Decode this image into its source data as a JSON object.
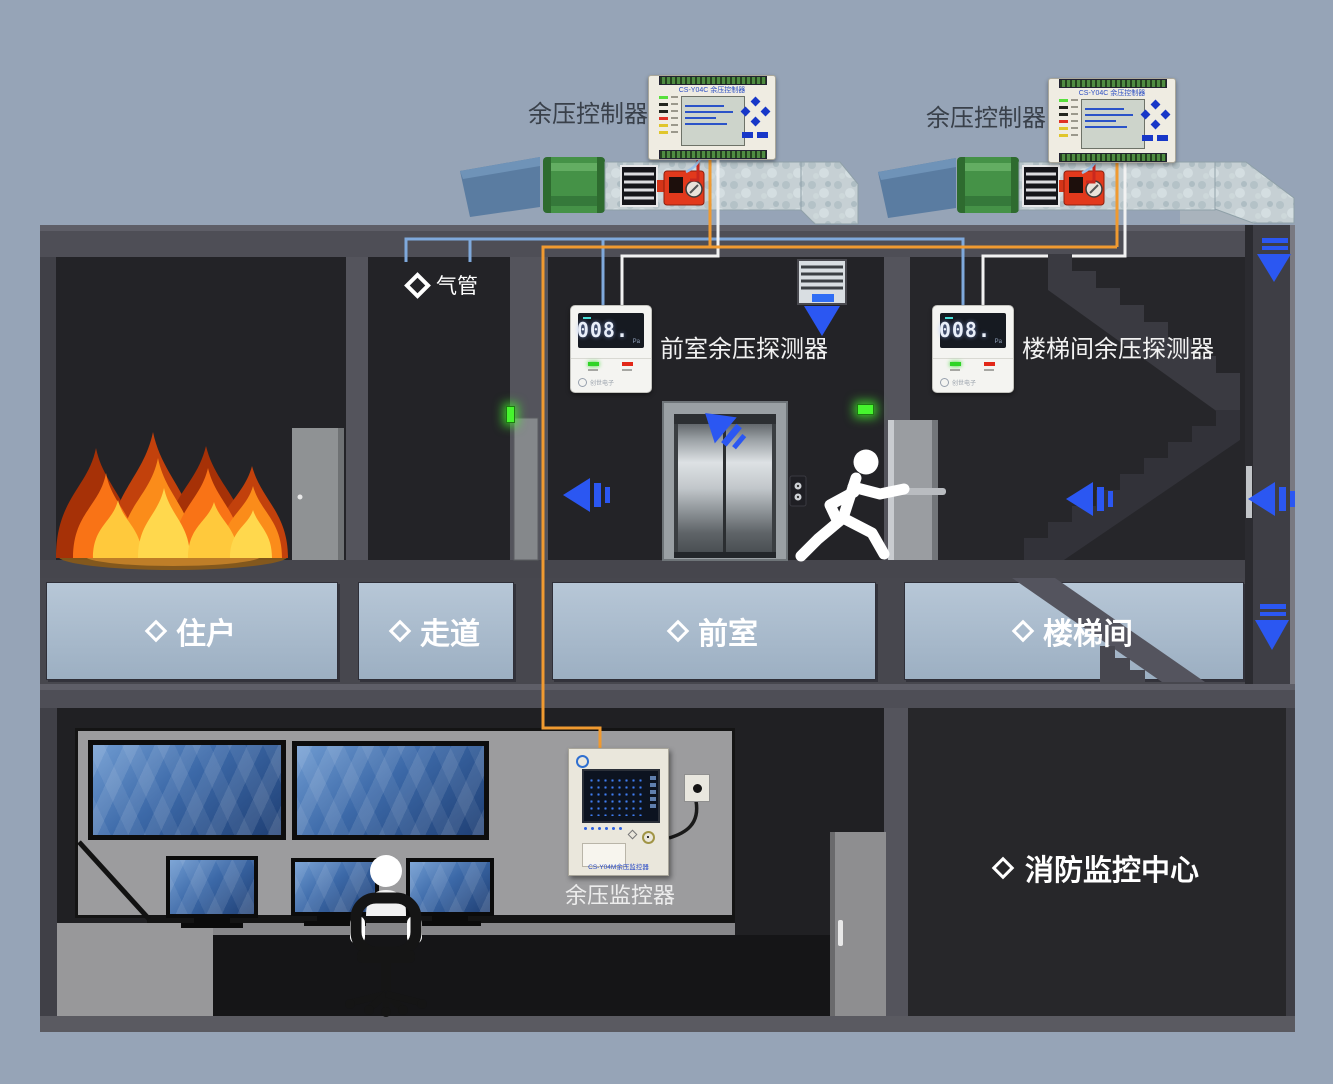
{
  "palette": {
    "background": "#96a4b7",
    "arrow_blue": "#2b57f2",
    "cable_orange": "#f09a30",
    "air_pipe_blue": "#7fa9dc",
    "cable_white": "#f2f2f2",
    "cable_red": "#c9281e",
    "exit_green": "#46f52e"
  },
  "controllers": {
    "label": "余压控制器",
    "model": "CS-Y04C 余压控制器"
  },
  "detectors": {
    "front_label": "前室余压探测器",
    "stair_label": "楼梯间余压探测器",
    "display_value": "008.",
    "display_unit": "Pa",
    "brand": "创世电子"
  },
  "monitor": {
    "label": "余压监控器",
    "model": "CS-Y04M余压监控器"
  },
  "rooms": {
    "resident": "住户",
    "corridor": "走道",
    "front_room": "前室",
    "stairwell": "楼梯间",
    "fire_center": "消防监控中心"
  },
  "annotations": {
    "air_pipe": "气管"
  }
}
